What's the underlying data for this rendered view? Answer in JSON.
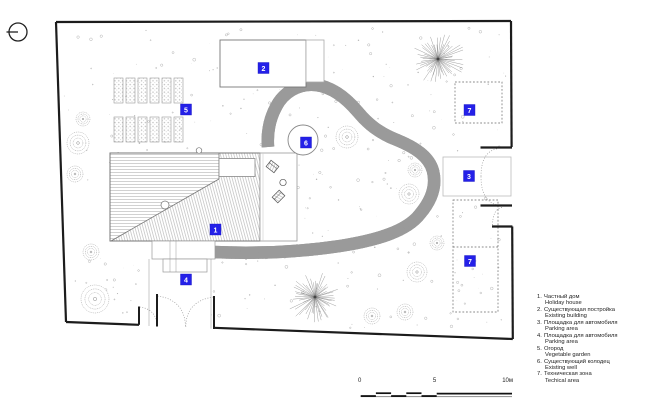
{
  "colors": {
    "label_blue": "#2420e8",
    "drawing_gray": "#999999",
    "boundary_black": "#1c1c1c"
  },
  "plan_labels": [
    {
      "num": "1"
    },
    {
      "num": "2"
    },
    {
      "num": "3"
    },
    {
      "num": "4"
    },
    {
      "num": "5"
    },
    {
      "num": "6"
    },
    {
      "num": "7"
    },
    {
      "num": "7"
    }
  ],
  "legend": {
    "items": [
      {
        "num": "1.",
        "ru": "Частный дом",
        "en": "Holiday house"
      },
      {
        "num": "2.",
        "ru": "Существующая постройка",
        "en": "Existing building"
      },
      {
        "num": "3.",
        "ru": "Площадка для автомобиля",
        "en": "Parking area"
      },
      {
        "num": "4.",
        "ru": "Площадка для автомобиля",
        "en": "Parking area"
      },
      {
        "num": "5.",
        "ru": "Огород",
        "en": "Vegetable garden"
      },
      {
        "num": "6.",
        "ru": "Существующий колодец",
        "en": "Existing well"
      },
      {
        "num": "7.",
        "ru": "Техническая зона",
        "en": "Techical area"
      }
    ]
  },
  "scale_bar": {
    "ticks": [
      "0",
      "5",
      "10м"
    ]
  }
}
